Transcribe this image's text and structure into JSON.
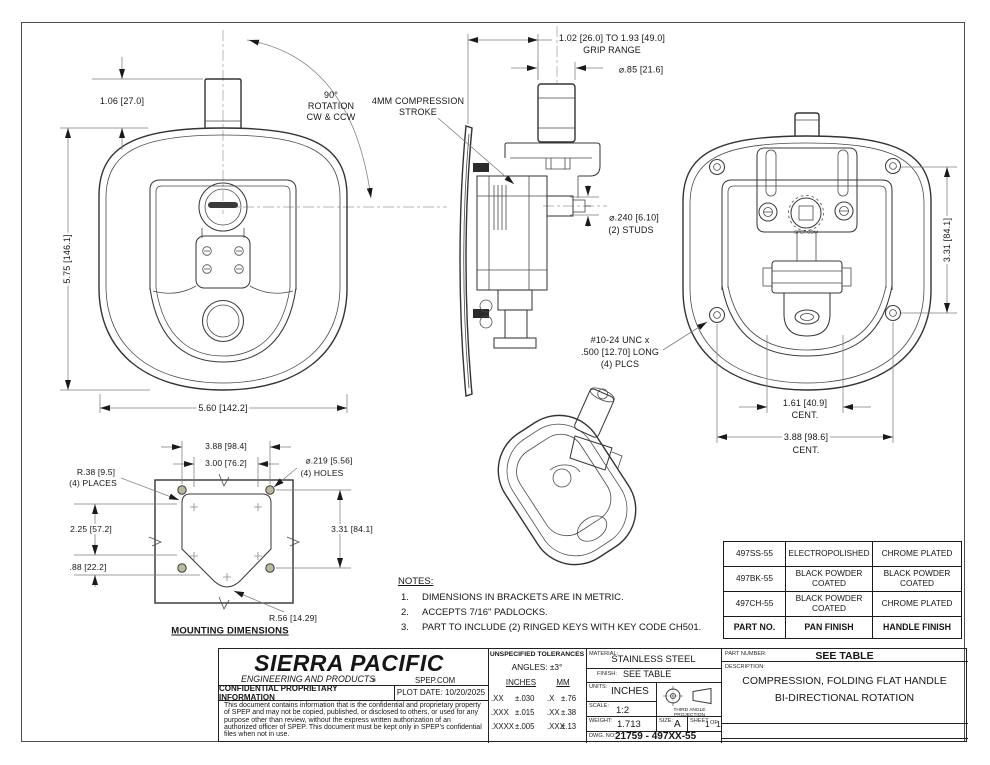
{
  "drawing": {
    "front_view": {
      "dim_offset": "1.06 [27.0]",
      "dim_height": "5.75 [146.1]",
      "dim_width": "5.60 [142.2]",
      "rotation_l1": "90°",
      "rotation_l2": "ROTATION",
      "rotation_l3": "CW & CCW"
    },
    "side_view": {
      "compression_l1": "4MM COMPRESSION",
      "compression_l2": "STROKE",
      "grip_l1": "1.02 [26.0] TO 1.93 [49.0]",
      "grip_l2": "GRIP RANGE",
      "knob_dia": "⌀.85 [21.6]",
      "studs_l1": "⌀.240 [6.10]",
      "studs_l2": "(2) STUDS"
    },
    "back_view": {
      "dim_height": "3.31 [84.1]",
      "screws_l1": "#10-24 UNC x",
      "screws_l2": ".500 [12.70] LONG",
      "screws_l3": "(4) PLCS",
      "cent_small_l1": "1.61 [40.9]",
      "cent_small_l2": "CENT.",
      "cent_large_l1": "3.88 [98.6]",
      "cent_large_l2": "CENT.",
      "gear_text": "SPEP.COM"
    },
    "mounting_view": {
      "title": "MOUNTING DIMENSIONS",
      "dim_width_outer": "3.88 [98.4]",
      "dim_width_inner": "3.00 [76.2]",
      "corner_radius_l1": "R.38 [9.5]",
      "corner_radius_l2": "(4) PLACES",
      "holes_l1": "⌀.219 [5.56]",
      "holes_l2": "(4) HOLES",
      "dim_height_upper": "2.25 [57.2]",
      "dim_height_lower": ".88 [22.2]",
      "dim_height_right": "3.31 [84.1]",
      "bottom_radius": "R.56 [14.29]"
    }
  },
  "notes": {
    "title": "NOTES:",
    "items": [
      {
        "num": "1.",
        "text": "DIMENSIONS IN BRACKETS ARE IN METRIC."
      },
      {
        "num": "2.",
        "text": "ACCEPTS 7/16\" PADLOCKS."
      },
      {
        "num": "3.",
        "text": "PART TO INCLUDE (2) RINGED KEYS WITH KEY CODE CH501."
      }
    ]
  },
  "finish_table": {
    "rows": [
      [
        "497SS-55",
        "ELECTROPOLISHED",
        "CHROME PLATED"
      ],
      [
        "497BK-55",
        "BLACK POWDER COATED",
        "BLACK POWDER COATED"
      ],
      [
        "497CH-55",
        "BLACK POWDER COATED",
        "CHROME PLATED"
      ]
    ],
    "footer": [
      "PART NO.",
      "PAN FINISH",
      "HANDLE FINISH"
    ]
  },
  "title_block": {
    "company_name": "SIERRA PACIFIC",
    "company_sub": "ENGINEERING AND PRODUCTS",
    "registered_mark": "®",
    "website": "SPEP.COM",
    "confidential_header": "CONFIDENTIAL PROPRIETARY INFORMATION",
    "plot_date": "PLOT DATE: 10/20/2025",
    "confidential_text": "This document contains information that is the confidential and proprietary property of SPEP and may not be copied, published, or disclosed to others, or used for any purpose other than review, without the express written authorization of an authorized officer of SPEP. This document must be kept only in SPEP's confidential files when not in use.",
    "tolerances": {
      "header": "UNSPECIFIED TOLERANCES",
      "angles": "ANGLES: ±3°",
      "col_inches": "INCHES",
      "col_mm": "MM",
      "rows": [
        {
          "in_key": ".XX",
          "in_val": "±.030",
          "mm_key": ".X",
          "mm_val": "±.76"
        },
        {
          "in_key": ".XXX",
          "in_val": "±.015",
          "mm_key": ".XX",
          "mm_val": "±.38"
        },
        {
          "in_key": ".XXXX",
          "in_val": "±.005",
          "mm_key": ".XXX",
          "mm_val": "±.13"
        }
      ]
    },
    "material_label": "MATERIAL:",
    "material": "STAINLESS STEEL",
    "finish_label": "FINISH:",
    "finish": "SEE TABLE",
    "units_label": "UNITS:",
    "units": "INCHES",
    "scale_label": "SCALE:",
    "scale": "1:2",
    "projection": "THIRD ANGLE PROJECTION",
    "weight_label": "WEIGHT:",
    "weight": "1.713",
    "size_label": "SIZE:",
    "size": "A",
    "sheet_label": "SHEET",
    "sheet_num": "1",
    "sheet_of": "OF",
    "sheet_total": "1",
    "dwg_label": "DWG. NO:",
    "dwg_no": "21759 - 497XX-55",
    "part_number_label": "PART NUMBER:",
    "part_number": "SEE TABLE",
    "description_label": "DESCRIPTION:",
    "description_l1": "COMPRESSION, FOLDING FLAT HANDLE",
    "description_l2": "BI-DIRECTIONAL ROTATION"
  },
  "colors": {
    "panel_fill": "#eae8c7",
    "line": "#3a3a3a",
    "dim_line": "#7e7e7e"
  }
}
